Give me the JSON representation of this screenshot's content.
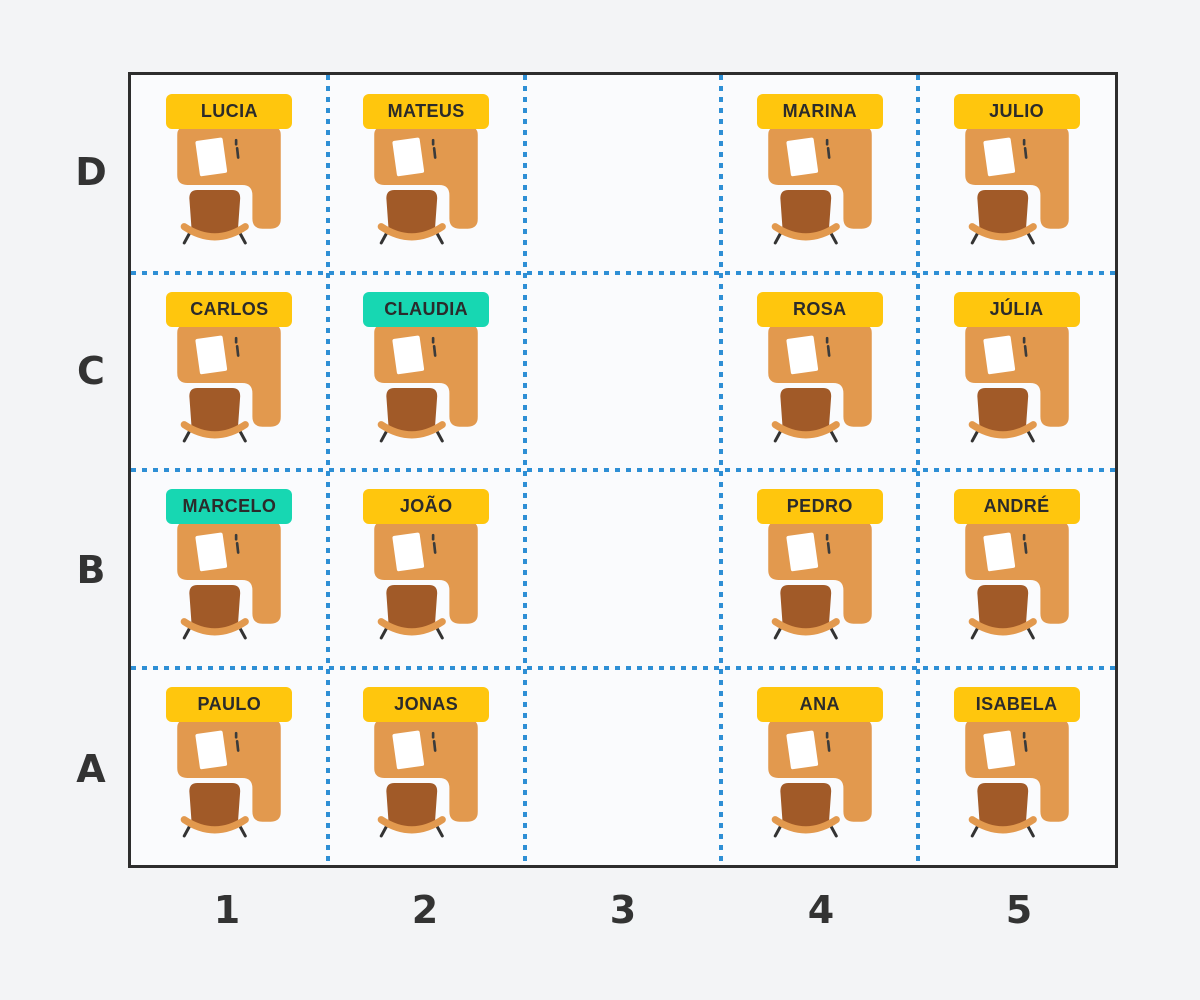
{
  "grid": {
    "rows": [
      "D",
      "C",
      "B",
      "A"
    ],
    "cols": [
      "1",
      "2",
      "3",
      "4",
      "5"
    ]
  },
  "seats": [
    {
      "row": "D",
      "col": "1",
      "name": "LUCIA",
      "highlight": false,
      "occupied": true
    },
    {
      "row": "D",
      "col": "2",
      "name": "MATEUS",
      "highlight": false,
      "occupied": true
    },
    {
      "row": "D",
      "col": "3",
      "name": "",
      "highlight": false,
      "occupied": false
    },
    {
      "row": "D",
      "col": "4",
      "name": "MARINA",
      "highlight": false,
      "occupied": true
    },
    {
      "row": "D",
      "col": "5",
      "name": "JULIO",
      "highlight": false,
      "occupied": true
    },
    {
      "row": "C",
      "col": "1",
      "name": "CARLOS",
      "highlight": false,
      "occupied": true
    },
    {
      "row": "C",
      "col": "2",
      "name": "CLAUDIA",
      "highlight": true,
      "occupied": true
    },
    {
      "row": "C",
      "col": "3",
      "name": "",
      "highlight": false,
      "occupied": false
    },
    {
      "row": "C",
      "col": "4",
      "name": "ROSA",
      "highlight": false,
      "occupied": true
    },
    {
      "row": "C",
      "col": "5",
      "name": "JÚLIA",
      "highlight": false,
      "occupied": true
    },
    {
      "row": "B",
      "col": "1",
      "name": "MARCELO",
      "highlight": true,
      "occupied": true
    },
    {
      "row": "B",
      "col": "2",
      "name": "JOÃO",
      "highlight": false,
      "occupied": true
    },
    {
      "row": "B",
      "col": "3",
      "name": "",
      "highlight": false,
      "occupied": false
    },
    {
      "row": "B",
      "col": "4",
      "name": "PEDRO",
      "highlight": false,
      "occupied": true
    },
    {
      "row": "B",
      "col": "5",
      "name": "ANDRÉ",
      "highlight": false,
      "occupied": true
    },
    {
      "row": "A",
      "col": "1",
      "name": "PAULO",
      "highlight": false,
      "occupied": true
    },
    {
      "row": "A",
      "col": "2",
      "name": "JONAS",
      "highlight": false,
      "occupied": true
    },
    {
      "row": "A",
      "col": "3",
      "name": "",
      "highlight": false,
      "occupied": false
    },
    {
      "row": "A",
      "col": "4",
      "name": "ANA",
      "highlight": false,
      "occupied": true
    },
    {
      "row": "A",
      "col": "5",
      "name": "ISABELA",
      "highlight": false,
      "occupied": true
    }
  ],
  "colors": {
    "page_bg": "#f3f4f6",
    "board_bg": "#fafbfd",
    "board_border": "#2d2d2d",
    "divider": "#2e8fd5",
    "tag_yellow": "#ffc60d",
    "tag_teal": "#17d7b2",
    "tag_text": "#2b2b2b",
    "label_text": "#333333",
    "desk": "#e2994e",
    "chair": "#a15a28",
    "paper": "#ffffff",
    "pen": "#3b3b3b",
    "feet": "#333333"
  }
}
